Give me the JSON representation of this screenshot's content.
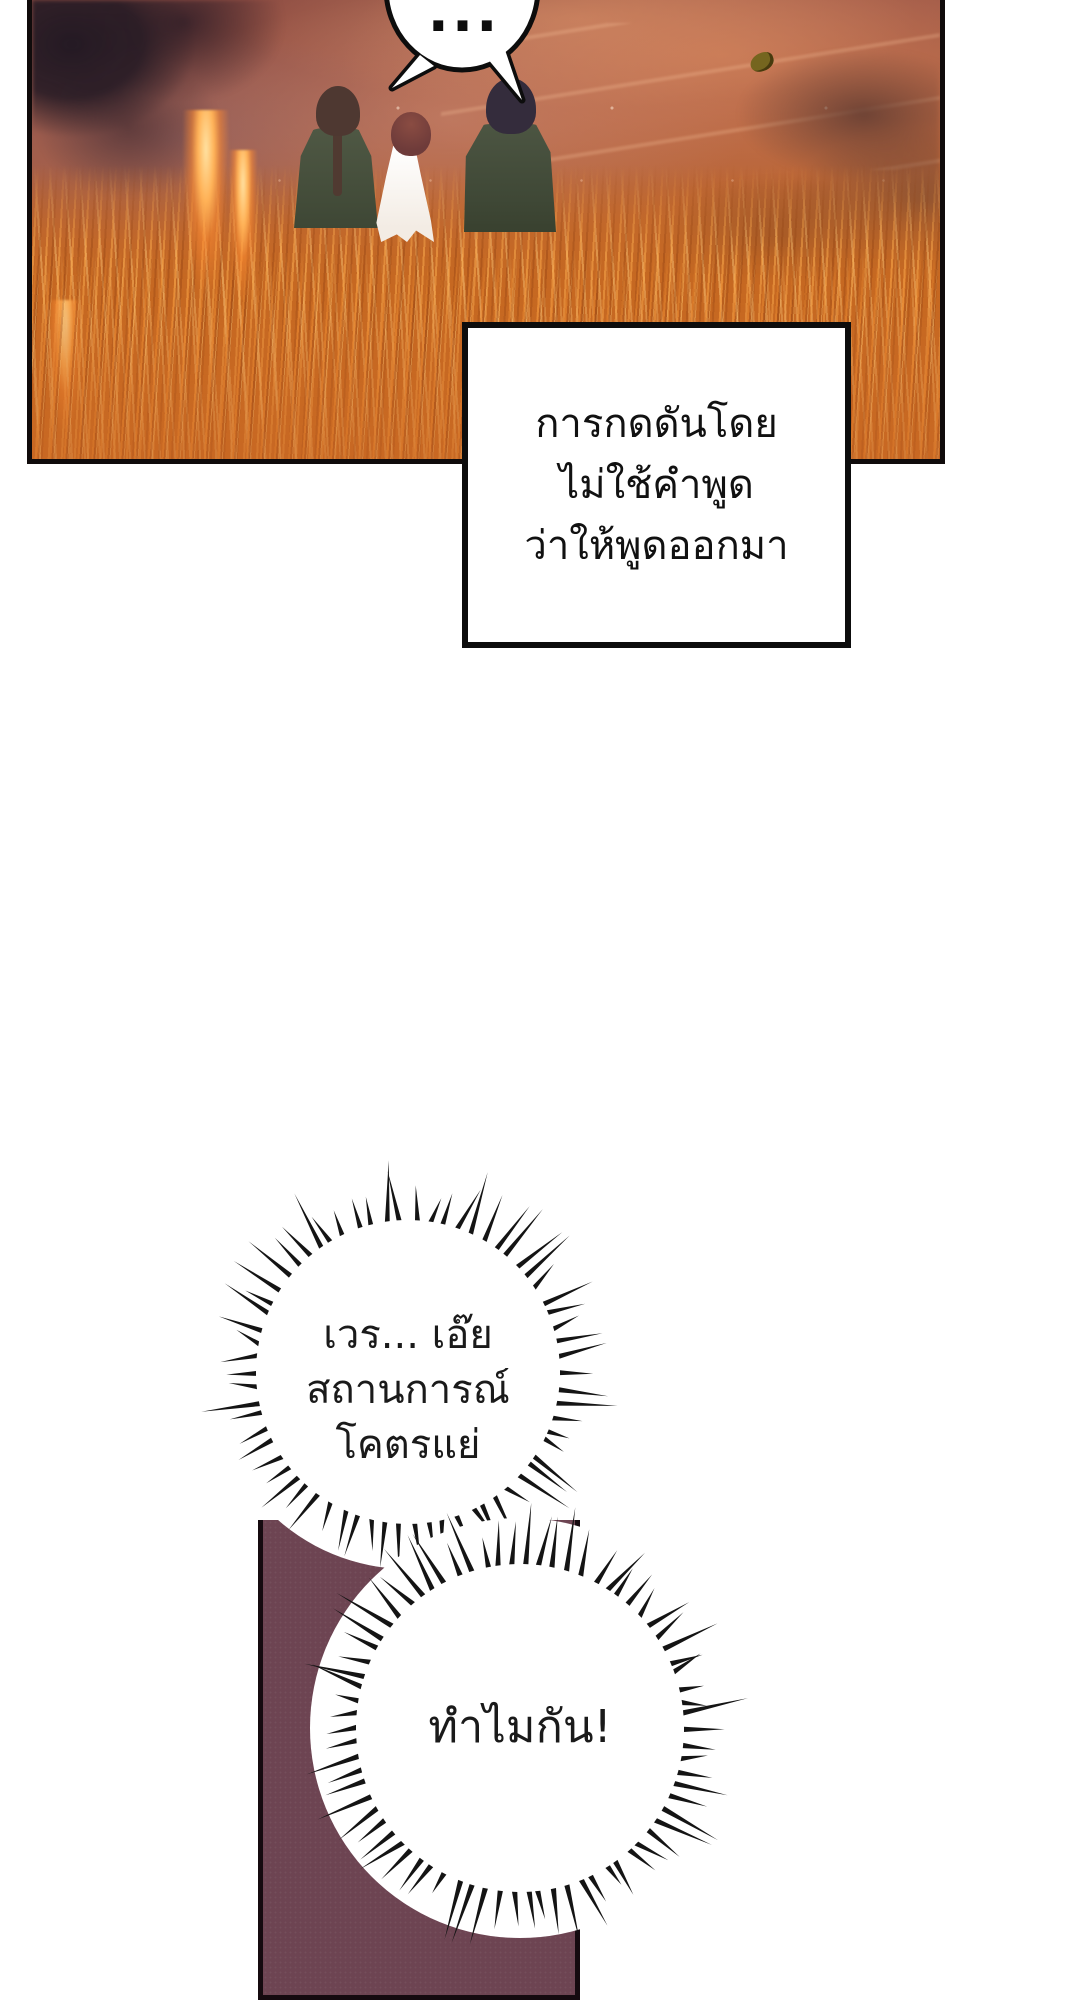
{
  "page": {
    "width": 1080,
    "height": 2000,
    "background": "#ffffff"
  },
  "panel_scene": {
    "description": "burning-grass-field-with-three-figures",
    "border_color": "#100b0b",
    "palette": {
      "sky_top": "#8a4a42",
      "sky_mid": "#b4613c",
      "field_orange": "#c4661f",
      "flame_highlight": "#ffd28a",
      "smoke_pink": "#c98a77",
      "smoke_purple": "#82606c",
      "trees_dark": "#31212b",
      "shrub_brown": "#613c32",
      "coat_green": "#4a5340",
      "hair_brown": "#4e3831",
      "hair_red": "#74403c",
      "dress_white": "#ffffff",
      "hair_navy": "#342c3c",
      "leaf_olive": "#75651f"
    }
  },
  "silence_bubble": {
    "text": "...",
    "fill": "#ffffff",
    "stroke": "#0d0d0d"
  },
  "narration_box": {
    "lines": [
      "การกดดันโดย",
      "ไม่ใช้คำพูด",
      "ว่าให้พูดออกมา"
    ],
    "fill": "#ffffff",
    "border_color": "#0d0d0d",
    "text_color": "#111111"
  },
  "burst_bubble_1": {
    "lines": [
      "เวร... เอ๊ย",
      "สถานการณ์",
      "โคตรแย่"
    ],
    "text_color": "#1a1a1a",
    "burst": {
      "w": 460,
      "h": 460,
      "cx": 230,
      "cy": 230,
      "inner_r": 152,
      "blob_r": 197,
      "tip_min": 172,
      "tip_max": 216,
      "count": 66,
      "seed": 7,
      "spike_color": "#141414",
      "fill": "#ffffff"
    }
  },
  "burst_bubble_2": {
    "lines": [
      "ทำไมกัน!"
    ],
    "text_color": "#1a1a1a",
    "burst": {
      "w": 480,
      "h": 480,
      "cx": 240,
      "cy": 240,
      "inner_r": 164,
      "blob_r": 210,
      "tip_min": 186,
      "tip_max": 230,
      "count": 74,
      "seed": 13,
      "spike_color": "#141414",
      "fill": "#ffffff"
    }
  },
  "bottom_panel": {
    "fill": "#6d4452",
    "border_color": "#150a0f"
  }
}
